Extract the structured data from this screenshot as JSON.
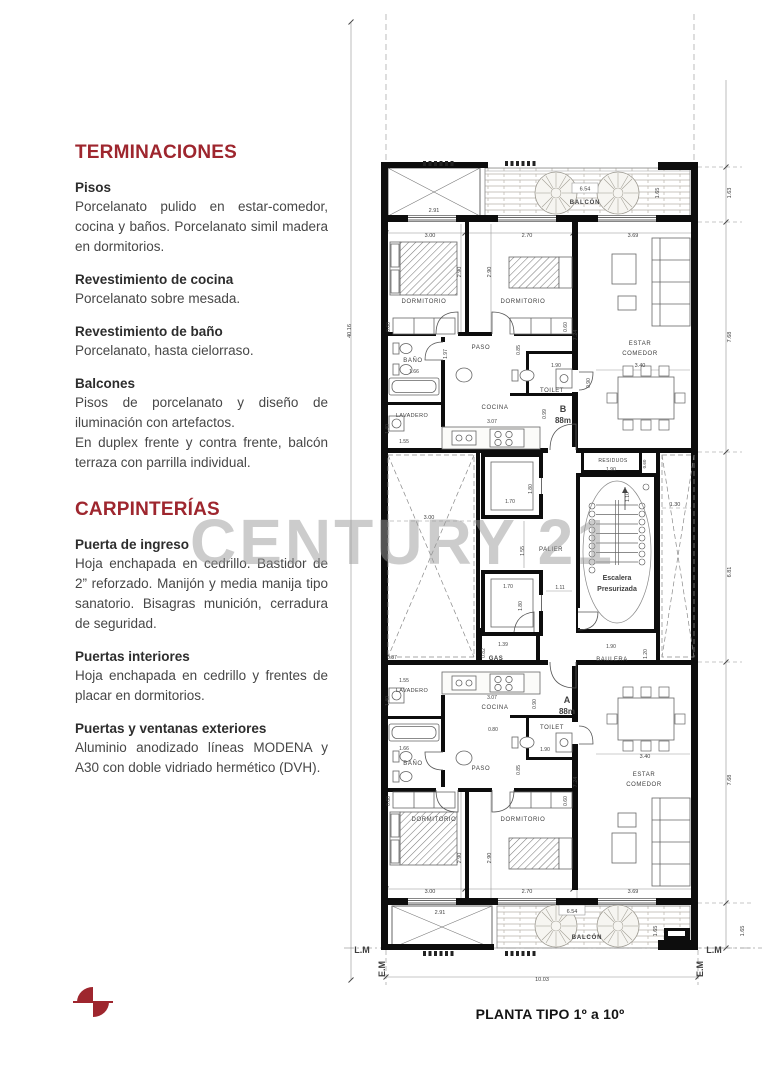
{
  "sidebar": {
    "sections": [
      {
        "heading": "TERMINACIONES",
        "items": [
          {
            "title": "Pisos",
            "body": "Porcelanato pulido en estar-comedor, cocina y baños. Porcelanato simil madera en dormitorios."
          },
          {
            "title": "Revestimiento de cocina",
            "body": "Porcelanato sobre mesada."
          },
          {
            "title": "Revestimiento de baño",
            "body": "Porcelanato, hasta cielorraso."
          },
          {
            "title": "Balcones",
            "body": "Pisos de porcelanato y diseño de iluminación con artefactos.\nEn duplex frente y contra frente, balcón terraza con parrilla individual."
          }
        ]
      },
      {
        "heading": "CARPINTERÍAS",
        "items": [
          {
            "title": "Puerta de ingreso",
            "body": "Hoja enchapada en cedrillo. Bastidor de 2” reforzado. Manijón y media manija tipo sanatorio. Bisagras munición, cerradura de seguridad."
          },
          {
            "title": "Puertas interiores",
            "body": "Hoja enchapada en cedrillo y frentes de placar en dormitorios."
          },
          {
            "title": "Puertas y ventanas exteriores",
            "body": "Aluminio anodizado líneas MODENA y A30 con doble vidriado hermético (DVH)."
          }
        ]
      }
    ]
  },
  "plan": {
    "caption": "PLANTA TIPO 1º a 10º",
    "watermark": "CENTURY 21",
    "accent_color": "#9e262e",
    "units": [
      {
        "id": "B",
        "area": "88m"
      },
      {
        "id": "A",
        "area": "88m"
      }
    ],
    "labels": [
      {
        "t": "2.91",
        "x": 434,
        "y": 212
      },
      {
        "t": "6.54",
        "x": 585,
        "y": 190.5
      },
      {
        "t": "BALCÓN",
        "x": 585,
        "y": 204,
        "s": 6,
        "b": 1,
        "ls": 0.8
      },
      {
        "t": "1.65",
        "x": 659,
        "y": 193,
        "r": -90
      },
      {
        "t": "1.63",
        "x": 731,
        "y": 193,
        "r": -90
      },
      {
        "t": "3.00",
        "x": 430,
        "y": 237
      },
      {
        "t": "2.70",
        "x": 527,
        "y": 237
      },
      {
        "t": "3.69",
        "x": 633,
        "y": 237
      },
      {
        "t": "2.90",
        "x": 461,
        "y": 272,
        "r": -90
      },
      {
        "t": "2.90",
        "x": 491,
        "y": 272,
        "r": -90
      },
      {
        "t": "DORMITORIO",
        "x": 424,
        "y": 303,
        "s": 6,
        "ls": 0.6
      },
      {
        "t": "DORMITORIO",
        "x": 523,
        "y": 303,
        "s": 6,
        "ls": 0.6
      },
      {
        "t": "0.60",
        "x": 390,
        "y": 327,
        "r": -90,
        "s": 5
      },
      {
        "t": "0.60",
        "x": 567,
        "y": 327,
        "r": -90,
        "s": 5
      },
      {
        "t": "ESTAR",
        "x": 640,
        "y": 345,
        "s": 6,
        "ls": 0.6
      },
      {
        "t": "COMEDOR",
        "x": 640,
        "y": 355,
        "s": 6,
        "ls": 0.6
      },
      {
        "t": "7.24",
        "x": 577,
        "y": 335,
        "r": -90
      },
      {
        "t": "7.68",
        "x": 731,
        "y": 337,
        "r": -90
      },
      {
        "t": "3.40",
        "x": 640,
        "y": 367
      },
      {
        "t": "BAÑO",
        "x": 413,
        "y": 362,
        "s": 6,
        "ls": 0.6
      },
      {
        "t": "1.97",
        "x": 447,
        "y": 354,
        "r": -90,
        "s": 5
      },
      {
        "t": "PASO",
        "x": 481,
        "y": 349,
        "s": 6,
        "ls": 0.6
      },
      {
        "t": "0.85",
        "x": 520,
        "y": 350,
        "r": -90,
        "s": 5
      },
      {
        "t": "1.66",
        "x": 414,
        "y": 373,
        "s": 5
      },
      {
        "t": "1.90",
        "x": 556,
        "y": 367,
        "s": 5
      },
      {
        "t": "TOILET",
        "x": 552,
        "y": 392,
        "s": 6,
        "ls": 0.5
      },
      {
        "t": "0.90",
        "x": 590,
        "y": 383,
        "r": -90,
        "s": 5
      },
      {
        "t": "B",
        "x": 563,
        "y": 412,
        "s": 9,
        "b": 1
      },
      {
        "t": "88m",
        "x": 563,
        "y": 423,
        "s": 8,
        "b": 1
      },
      {
        "t": "COCINA",
        "x": 495,
        "y": 409,
        "s": 6,
        "ls": 0.6
      },
      {
        "t": "LAVADERO",
        "x": 412,
        "y": 417,
        "s": 5.5,
        "ls": 0.4
      },
      {
        "t": "3.07",
        "x": 492,
        "y": 423,
        "s": 5
      },
      {
        "t": "0.99",
        "x": 546,
        "y": 414,
        "r": -90,
        "s": 5
      },
      {
        "t": "1.55",
        "x": 404,
        "y": 443,
        "s": 5
      },
      {
        "t": "1.40",
        "x": 389,
        "y": 429,
        "r": -90,
        "s": 5
      },
      {
        "t": "40.16",
        "x": 351,
        "y": 331,
        "r": -90
      },
      {
        "t": "RESIDUOS",
        "x": 613,
        "y": 462,
        "s": 5,
        "ls": 0.4
      },
      {
        "t": "1.90",
        "x": 611,
        "y": 471,
        "s": 5
      },
      {
        "t": "0.60",
        "x": 646,
        "y": 464,
        "r": -90,
        "s": 4.5
      },
      {
        "t": "1.80",
        "x": 532,
        "y": 489,
        "r": -90,
        "s": 5
      },
      {
        "t": "1.70",
        "x": 510,
        "y": 503,
        "s": 5
      },
      {
        "t": "1.10",
        "x": 629,
        "y": 497,
        "r": -90,
        "s": 5
      },
      {
        "t": "3.00",
        "x": 429,
        "y": 519
      },
      {
        "t": "1.30",
        "x": 675,
        "y": 506
      },
      {
        "t": "1.55",
        "x": 524,
        "y": 551,
        "r": -90,
        "s": 5
      },
      {
        "t": "PALIER",
        "x": 551,
        "y": 551,
        "s": 6,
        "ls": 0.5
      },
      {
        "t": "1.70",
        "x": 508,
        "y": 588,
        "s": 5
      },
      {
        "t": "1.80",
        "x": 522,
        "y": 606,
        "r": -90,
        "s": 5
      },
      {
        "t": "1.11",
        "x": 560,
        "y": 589,
        "s": 5
      },
      {
        "t": "Escalera",
        "x": 617,
        "y": 580,
        "s": 7,
        "b": 1
      },
      {
        "t": "Presurizada",
        "x": 617,
        "y": 591,
        "s": 7,
        "b": 1
      },
      {
        "t": "6.81",
        "x": 731,
        "y": 572,
        "r": -90
      },
      {
        "t": "0.87",
        "x": 392,
        "y": 659,
        "s": 5
      },
      {
        "t": "GAS",
        "x": 496,
        "y": 660,
        "s": 6,
        "b": 1,
        "ls": 0.5
      },
      {
        "t": "1.39",
        "x": 503,
        "y": 646,
        "s": 5
      },
      {
        "t": "0.82",
        "x": 485,
        "y": 653,
        "r": -90,
        "s": 5
      },
      {
        "t": "BAULERA",
        "x": 612,
        "y": 661,
        "s": 6,
        "ls": 0.5
      },
      {
        "t": "1.90",
        "x": 611,
        "y": 648,
        "s": 5
      },
      {
        "t": "1.20",
        "x": 647,
        "y": 654,
        "r": -90,
        "s": 5
      },
      {
        "t": "1.55",
        "x": 404,
        "y": 682,
        "s": 5
      },
      {
        "t": "LAVADERO",
        "x": 412,
        "y": 692,
        "s": 5.5,
        "ls": 0.4
      },
      {
        "t": "1.40",
        "x": 389,
        "y": 701,
        "r": -90,
        "s": 5
      },
      {
        "t": "3.07",
        "x": 492,
        "y": 699,
        "s": 5
      },
      {
        "t": "COCINA",
        "x": 495,
        "y": 709,
        "s": 6,
        "ls": 0.6
      },
      {
        "t": "0.90",
        "x": 536,
        "y": 704,
        "r": -90,
        "s": 5
      },
      {
        "t": "A",
        "x": 567,
        "y": 703,
        "s": 9,
        "b": 1
      },
      {
        "t": "88m",
        "x": 567,
        "y": 714,
        "s": 8,
        "b": 1
      },
      {
        "t": "TOILET",
        "x": 552,
        "y": 729,
        "s": 6,
        "ls": 0.5
      },
      {
        "t": "0.80",
        "x": 493,
        "y": 731,
        "s": 5
      },
      {
        "t": "1.90",
        "x": 545,
        "y": 751,
        "s": 5
      },
      {
        "t": "1.66",
        "x": 404,
        "y": 750,
        "s": 5
      },
      {
        "t": "BAÑO",
        "x": 413,
        "y": 765,
        "s": 6,
        "ls": 0.6
      },
      {
        "t": "PASO",
        "x": 481,
        "y": 770,
        "s": 6,
        "ls": 0.6
      },
      {
        "t": "0.85",
        "x": 520,
        "y": 770,
        "r": -90,
        "s": 5
      },
      {
        "t": "3.40",
        "x": 645,
        "y": 758
      },
      {
        "t": "ESTAR",
        "x": 644,
        "y": 776,
        "s": 6,
        "ls": 0.6
      },
      {
        "t": "COMEDOR",
        "x": 644,
        "y": 786,
        "s": 6,
        "ls": 0.6
      },
      {
        "t": "7.24",
        "x": 577,
        "y": 782,
        "r": -90
      },
      {
        "t": "7.68",
        "x": 731,
        "y": 780,
        "r": -90
      },
      {
        "t": "DORMITORIO",
        "x": 434,
        "y": 821,
        "s": 6,
        "ls": 0.6
      },
      {
        "t": "DORMITORIO",
        "x": 523,
        "y": 821,
        "s": 6,
        "ls": 0.6
      },
      {
        "t": "0.60",
        "x": 390,
        "y": 801,
        "r": -90,
        "s": 5
      },
      {
        "t": "0.60",
        "x": 567,
        "y": 801,
        "r": -90,
        "s": 5
      },
      {
        "t": "2.90",
        "x": 461,
        "y": 858,
        "r": -90
      },
      {
        "t": "2.90",
        "x": 491,
        "y": 858,
        "r": -90
      },
      {
        "t": "3.00",
        "x": 430,
        "y": 893
      },
      {
        "t": "2.70",
        "x": 527,
        "y": 893
      },
      {
        "t": "3.69",
        "x": 633,
        "y": 893
      },
      {
        "t": "2.91",
        "x": 440,
        "y": 914
      },
      {
        "t": "6.54",
        "x": 572,
        "y": 913
      },
      {
        "t": "BALCÓN",
        "x": 587,
        "y": 939,
        "s": 6,
        "b": 1,
        "ls": 0.8
      },
      {
        "t": "1.65",
        "x": 657,
        "y": 931,
        "r": -90
      },
      {
        "t": "1.65",
        "x": 744,
        "y": 931,
        "r": -90
      },
      {
        "t": "L.M",
        "x": 362,
        "y": 953,
        "s": 9,
        "b": 1
      },
      {
        "t": "L.M",
        "x": 714,
        "y": 953,
        "s": 9,
        "b": 1
      },
      {
        "t": "E.M",
        "x": 385,
        "y": 969,
        "r": -90,
        "s": 9,
        "b": 1
      },
      {
        "t": "E.M",
        "x": 703,
        "y": 969,
        "r": -90,
        "s": 9,
        "b": 1
      },
      {
        "t": "10.03",
        "x": 542,
        "y": 981
      }
    ]
  }
}
